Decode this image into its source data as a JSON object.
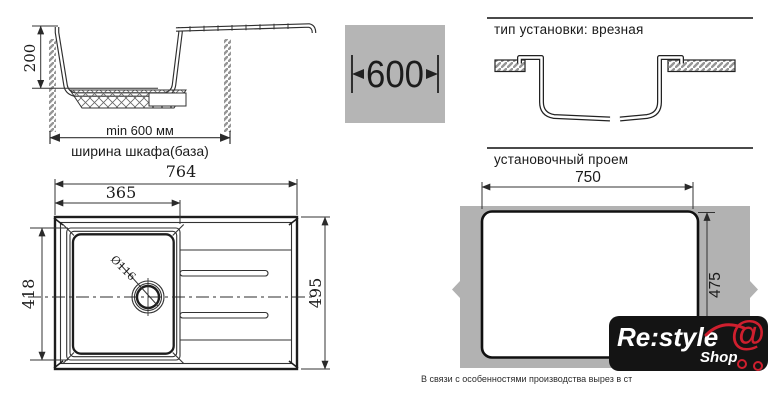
{
  "side_view": {
    "depth_label": "200",
    "min_width_label": "min 600 мм",
    "cabinet_width_label": "ширина шкафа(база)"
  },
  "cabinet_width_badge": {
    "value": "600"
  },
  "installation_type": {
    "title": "тип установки: врезная"
  },
  "cutout": {
    "title": "установочный проем",
    "width": "750",
    "height": "475"
  },
  "top_view": {
    "overall_width": "764",
    "bowl_width": "365",
    "bowl_depth": "418",
    "overall_depth": "495",
    "drain_diameter": "Ø116"
  },
  "footnote": "В связи с особенностями производства вырез в ст",
  "logo": {
    "brand": "Re:style",
    "shop": "Shop",
    "at_symbol": "@"
  },
  "colors": {
    "line": "#333333",
    "badge_bg": "#b5b5b5",
    "countertop_gray": "#b2b2b2",
    "logo_bg": "#141414",
    "logo_red": "#cf1f2e"
  }
}
